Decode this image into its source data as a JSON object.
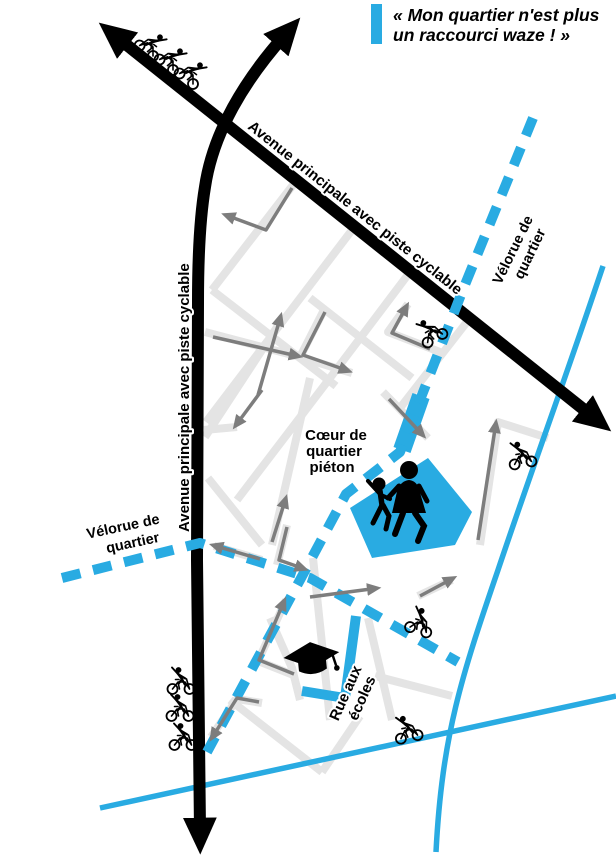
{
  "quote": {
    "line1": "« Mon quartier n'est plus",
    "line2": "un raccourci waze ! »"
  },
  "labels": {
    "avenue_diagonal": "Avenue principale avec piste cyclable",
    "avenue_vertical": "Avenue principale avec piste cyclable",
    "velorue_top_right": {
      "line1": "Vélorue de",
      "line2": "quartier"
    },
    "velorue_left": {
      "line1": "Vélorue de",
      "line2": "quartier"
    },
    "pedestrian_heart": {
      "line1": "Cœur de",
      "line2": "quartier",
      "line3": "piéton"
    },
    "school_street": {
      "line1": "Rue aux",
      "line2": "écoles"
    }
  },
  "colors": {
    "velorue_blue": "#29abe2",
    "street_gray": "#e4e4e4",
    "arrow_gray": "#7d7d7d",
    "road_black": "#000000"
  },
  "icons": {
    "bicycle": "bicycle-icon",
    "family": "family-icon",
    "graduation_cap": "graduation-cap-icon",
    "arrowhead": "direction-arrow-icon"
  }
}
